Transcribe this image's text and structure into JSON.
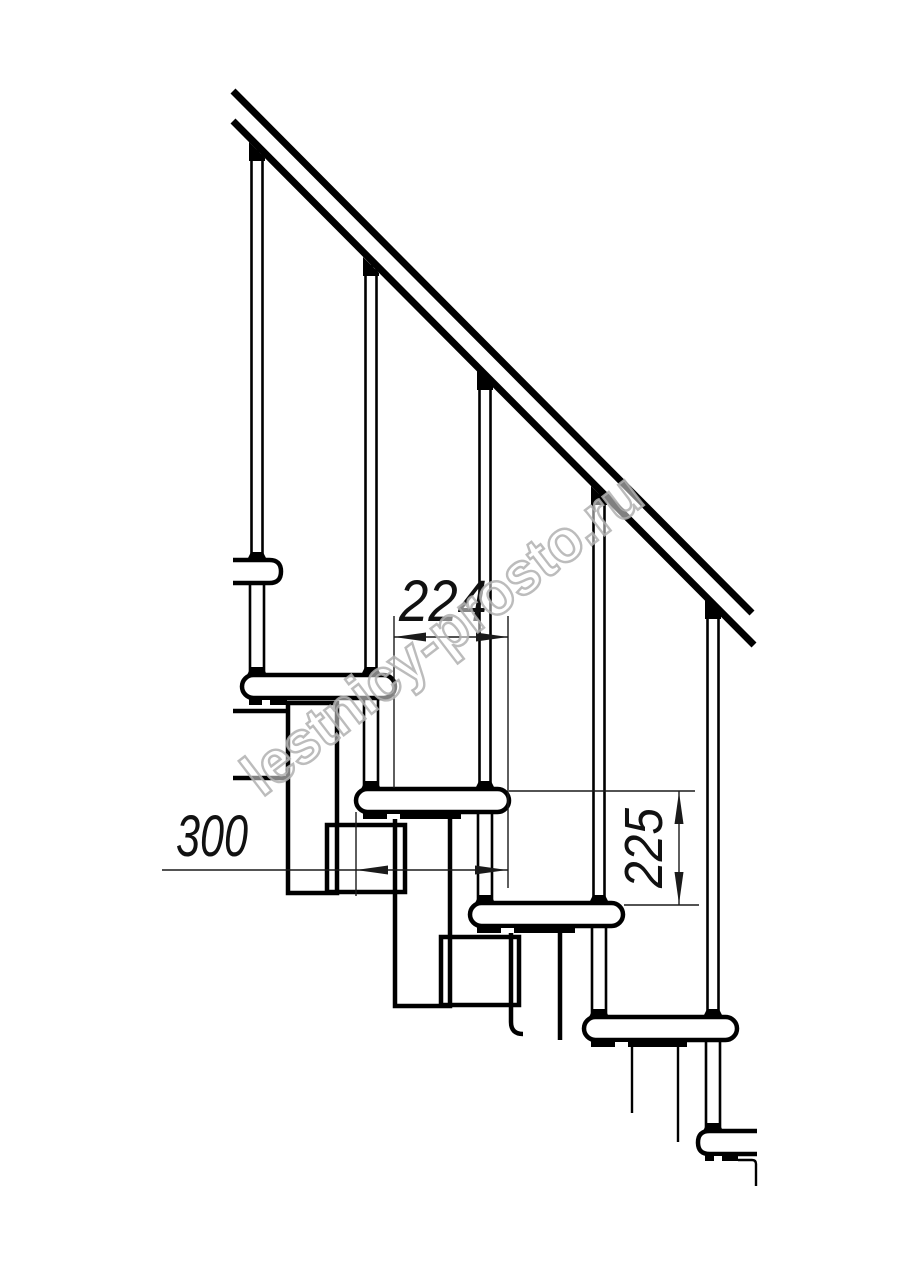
{
  "page": {
    "background": "#ffffff"
  },
  "drawing": {
    "type": "technical-line-drawing",
    "subject": "modular staircase side elevation",
    "line_color": "#000000",
    "dimension_line_color": "#1a1a1a",
    "structure": {
      "balusters": 5,
      "treads_visible": 6,
      "handrail_lines": 2
    }
  },
  "dimensions": {
    "step_run": {
      "label": "224",
      "value": 224,
      "orientation": "horizontal"
    },
    "tread_depth": {
      "label": "300",
      "value": 300,
      "orientation": "horizontal"
    },
    "step_rise": {
      "label": "225",
      "value": 225,
      "orientation": "vertical"
    }
  },
  "watermark": {
    "text": "lestnicy-prosto.ru",
    "color": "#b0b0b0"
  }
}
